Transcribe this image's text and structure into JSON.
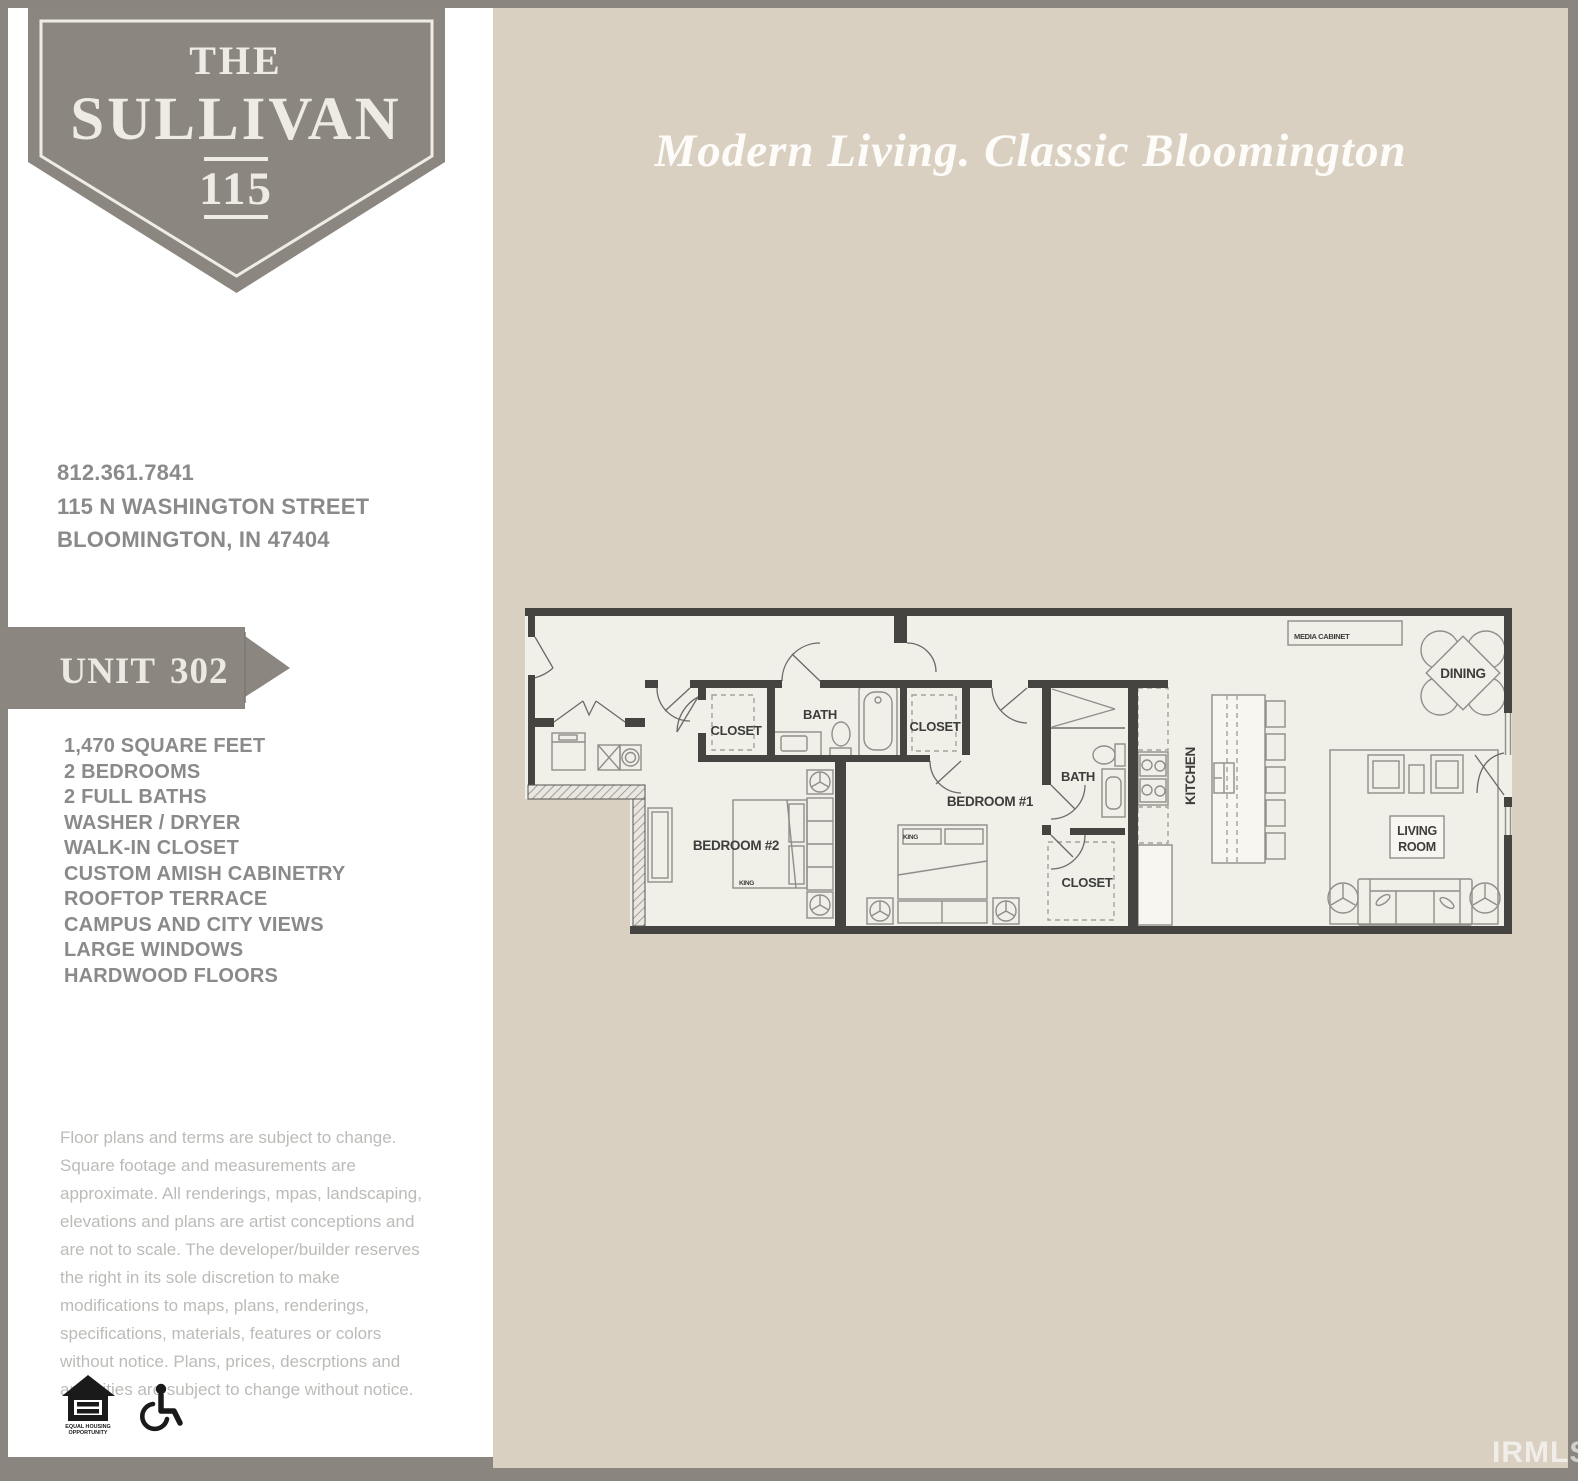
{
  "page": {
    "frame_color": "#8a857f",
    "sidebar_bg": "#ffffff",
    "panel_bg": "#d9d0c2",
    "watermark": "IRMLS"
  },
  "badge": {
    "line1": "THE",
    "line2": "SULLIVAN",
    "line3": "115"
  },
  "tagline": "Modern Living. Classic Bloomington",
  "contact": {
    "phone": "812.361.7841",
    "address1": "115 N WASHINGTON STREET",
    "address2": "BLOOMINGTON, IN 47404"
  },
  "unit": {
    "label": "UNIT",
    "number": "302"
  },
  "features": [
    "1,470 SQUARE FEET",
    "2 BEDROOMS",
    "2 FULL BATHS",
    "WASHER / DRYER",
    "WALK-IN CLOSET",
    "CUSTOM AMISH CABINETRY",
    "ROOFTOP TERRACE",
    "CAMPUS AND CITY VIEWS",
    "LARGE WINDOWS",
    "HARDWOOD FLOORS"
  ],
  "disclaimer": "Floor plans and terms are subject to change. Square footage and measurements are approximate. All renderings, mpas, landscaping, elevations and plans are artist conceptions and are not to scale. The developer/builder reserves the right in its sole discretion to make modifications to maps, plans, renderings, specifications, materials, features or colors without notice. Plans, prices, descrptions and amenities are subject to change without notice.",
  "legal_icons": {
    "eho_line1": "EQUAL HOUSING",
    "eho_line2": "OPPORTUNITY"
  },
  "floorplan": {
    "labels": {
      "closet_bedroom2": "CLOSET",
      "bath_bedroom2": "BATH",
      "closet_bedroom1": "CLOSET",
      "bedroom1": "BEDROOM #1",
      "bedroom2": "BEDROOM #2",
      "bath_bedroom1": "BATH",
      "walk_in_closet": "CLOSET",
      "kitchen": "KITCHEN",
      "dining": "DINING",
      "living_line1": "LIVING",
      "living_line2": "ROOM",
      "media_cabinet": "MEDIA CABINET",
      "king_bed1": "KING",
      "king_bed2": "KING"
    }
  }
}
